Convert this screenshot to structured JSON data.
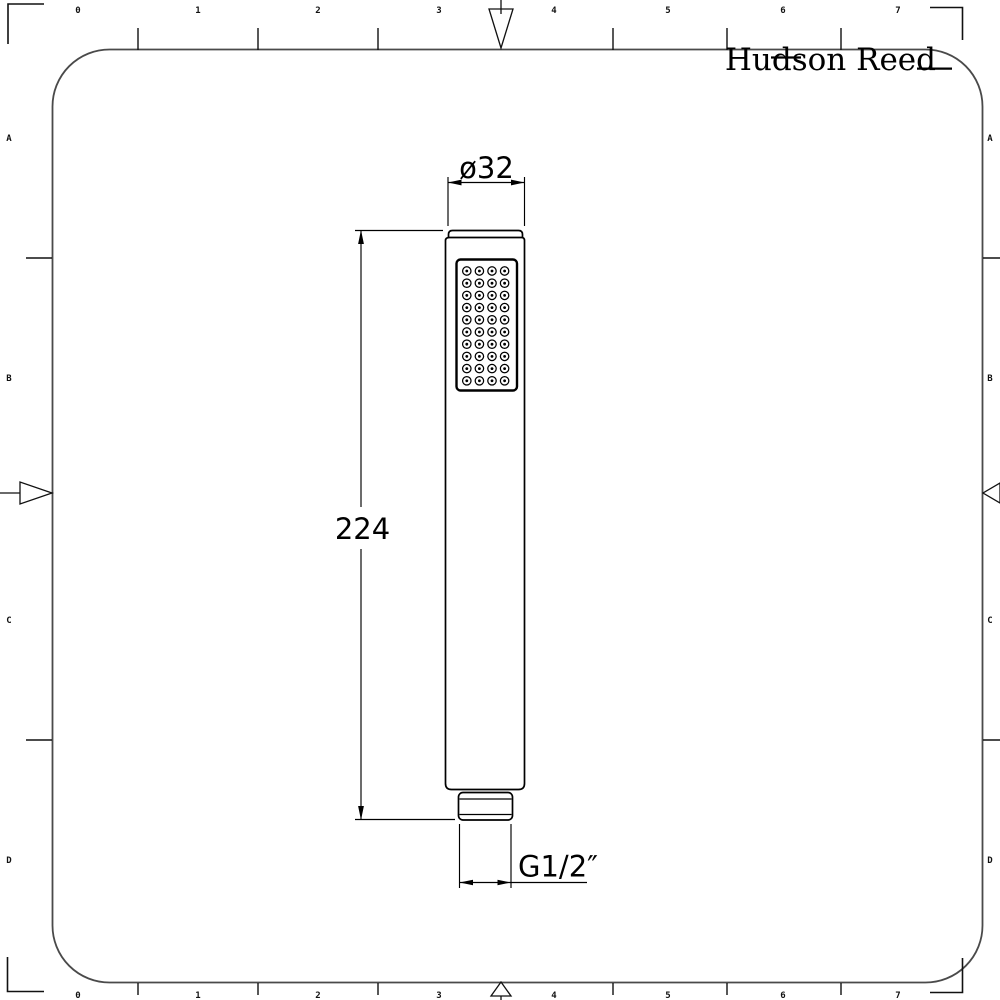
{
  "logo": {
    "text": "Hudson Reed"
  },
  "drawing": {
    "subject": "handheld shower wand, front elevation",
    "dimensions": {
      "diameter_label": "ø32",
      "length_label": "224",
      "thread_label": "G1/2″"
    },
    "nozzles": {
      "rows": 10,
      "cols": 4,
      "x0": 466.8,
      "dx": 12.6,
      "y0": 271,
      "dy": 12.2,
      "r_outer": 4.2,
      "r_inner": 1.4
    }
  },
  "ruler": {
    "top_numbers": [
      "0",
      "1",
      "2",
      "3",
      "4",
      "5",
      "6",
      "7"
    ],
    "bottom_numbers": [
      "0",
      "1",
      "2",
      "3",
      "4",
      "5",
      "6",
      "7"
    ],
    "left_letters": [
      "A",
      "B",
      "C",
      "D"
    ],
    "right_letters": [
      "A",
      "B",
      "C",
      "D"
    ]
  },
  "colors": {
    "line": "#000000",
    "ink": "#111111",
    "frame": "#4a4a4a",
    "background": "#ffffff"
  }
}
